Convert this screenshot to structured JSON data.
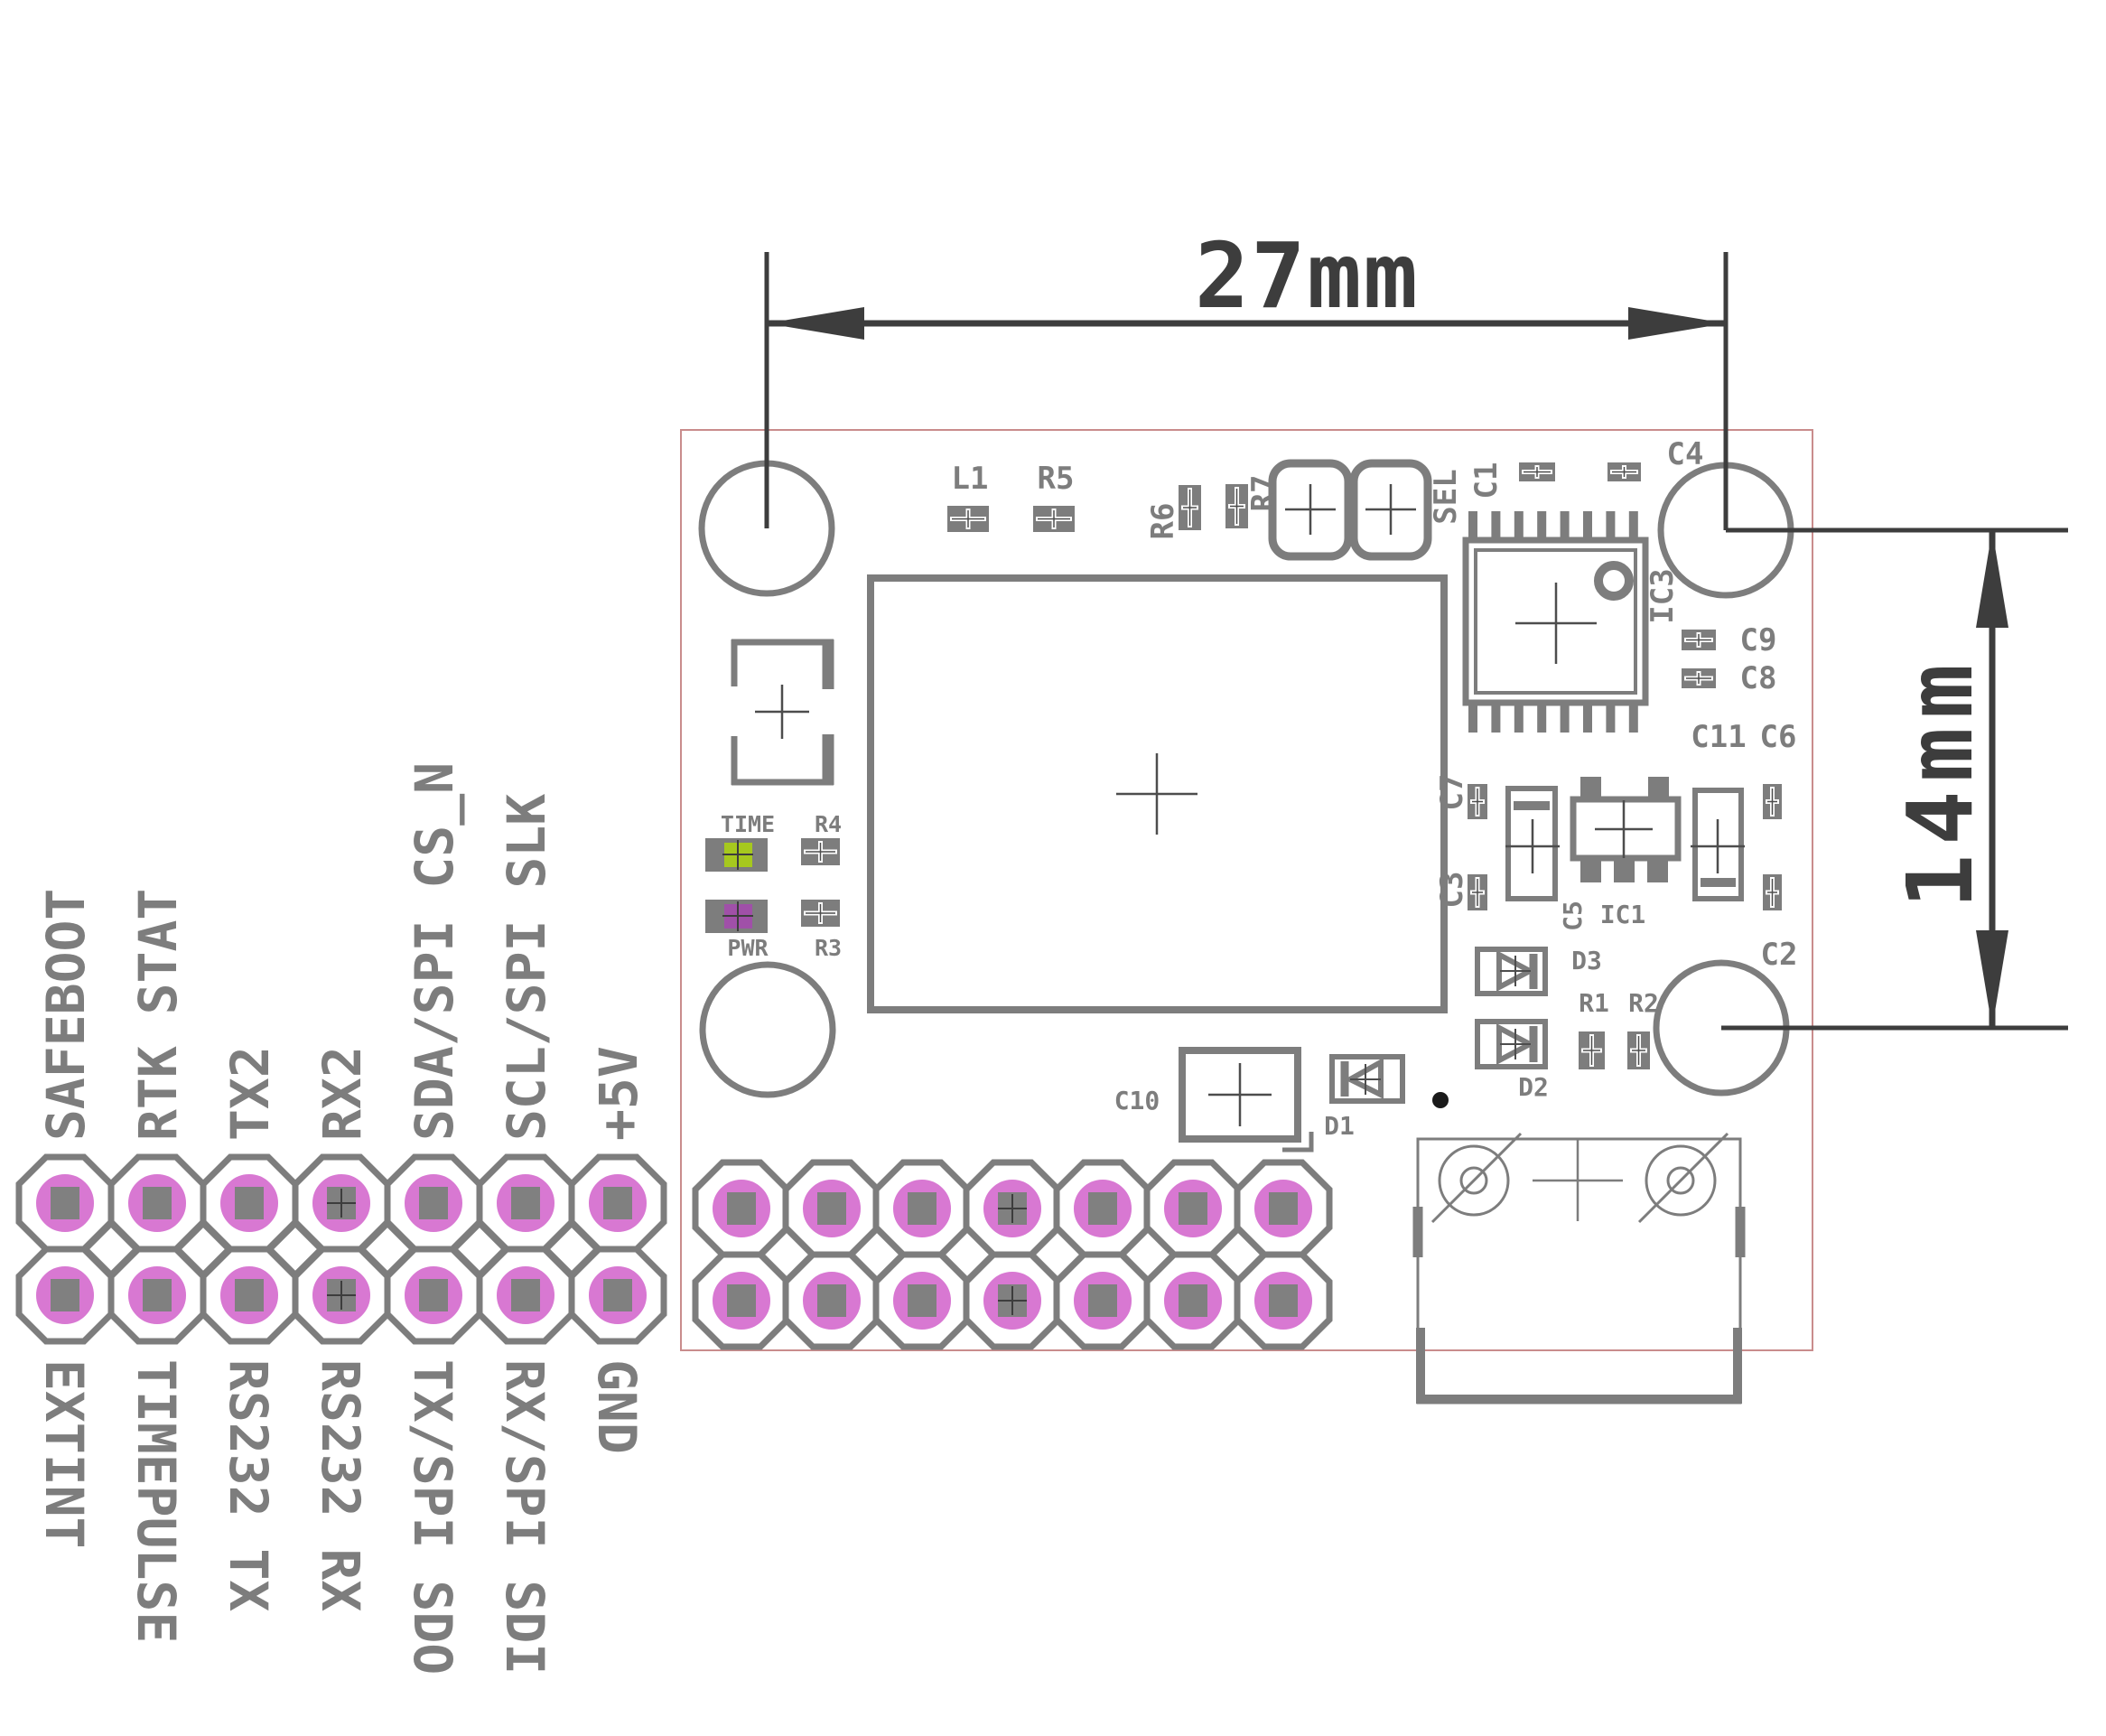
{
  "colors": {
    "silk": "#7d7d7d",
    "dim": "#3d3d3d",
    "board_outline": "#c98c8c",
    "pad_ring": "#d878d2",
    "pad_center": "#808080",
    "led_time": "#a6c81e",
    "led_pwr": "#a050a8",
    "dot": "#1a1a1a",
    "cross": "#4d4d4d"
  },
  "dimensions": {
    "horizontal": "27mm",
    "vertical": "14mm"
  },
  "pin_header": {
    "top_labels": [
      "SAFEBOOT",
      "RTK STAT",
      "TX2",
      "RX2",
      "SDA/SPI CS_N",
      "SCL/SPI SLK",
      "+5V"
    ],
    "bottom_labels": [
      "EXTINT",
      "TIMEPULSE",
      "RS232 TX",
      "RS232 RX",
      "TX/SPI SDO",
      "RX/SPI SDI",
      "GND"
    ]
  },
  "components": {
    "l1": "L1",
    "r5": "R5",
    "r6": "R6",
    "r7": "R7",
    "sel": "SEL",
    "c1": "C1",
    "c4": "C4",
    "ic3": "IC3",
    "c9": "C9",
    "c8": "C8",
    "c11": "C11",
    "c6": "C6",
    "c7": "C7",
    "c3": "C3",
    "c5": "C5",
    "ic1": "IC1",
    "d3": "D3",
    "r1": "R1",
    "r2": "R2",
    "d2": "D2",
    "c2": "C2",
    "c10": "C10",
    "d1": "D1",
    "time": "TIME",
    "pwr": "PWR",
    "r4": "R4",
    "r3": "R3"
  }
}
